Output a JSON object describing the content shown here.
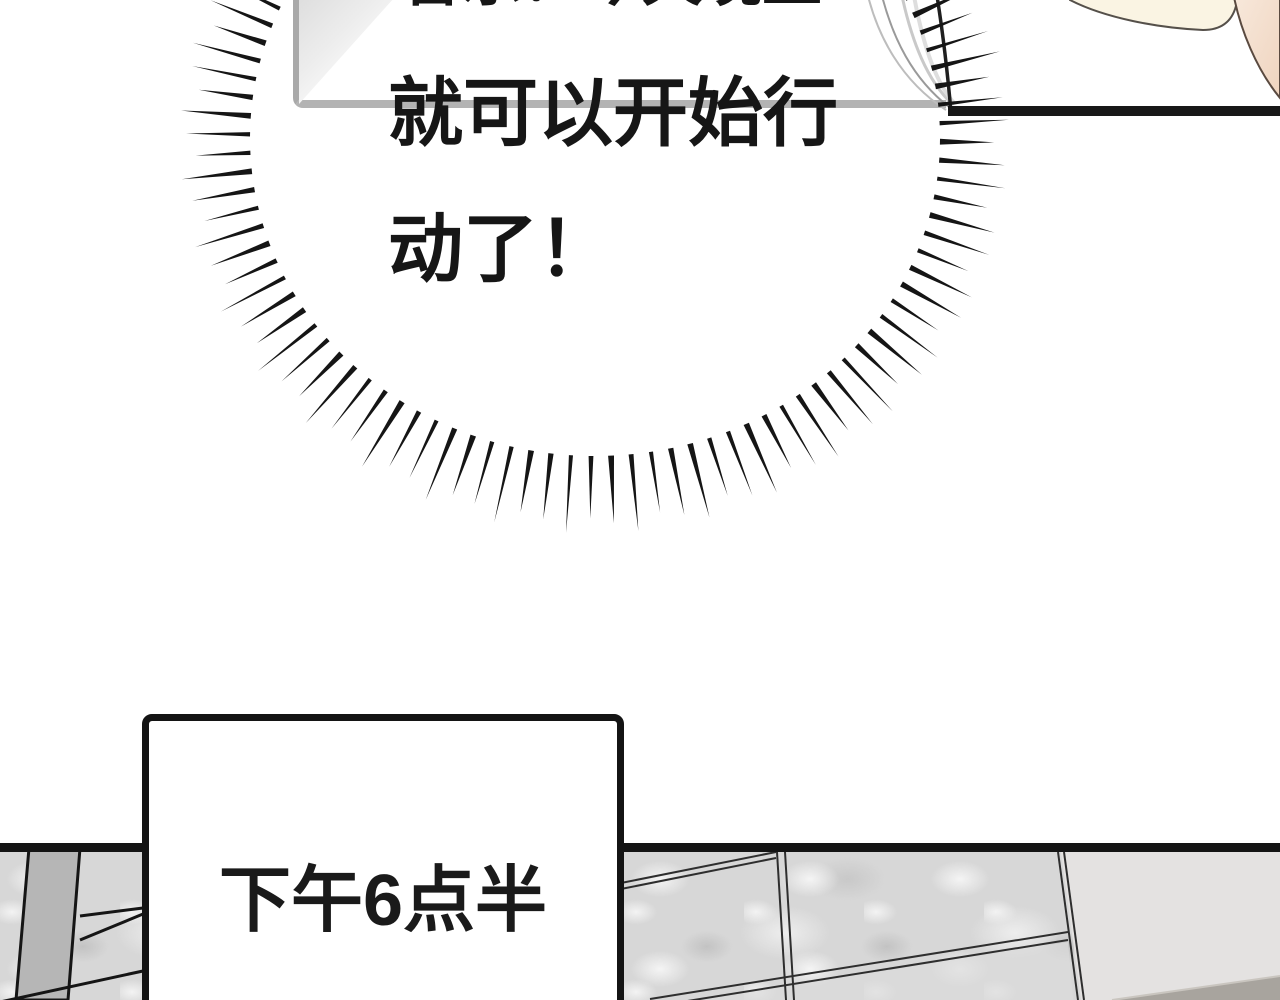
{
  "bubble": {
    "lines": [
      "音乐？今天晚上",
      "就可以开始行",
      "动了！"
    ]
  },
  "caption": {
    "text": "下午6点半"
  },
  "burst": {
    "cx": 595,
    "cy": 138,
    "irx": 345,
    "iry": 318,
    "orx": 408,
    "ory": 387,
    "start_deg": -26,
    "end_deg": 204,
    "count": 70,
    "base_width": 5,
    "color": "#151515"
  },
  "colors": {
    "ink": "#161616",
    "top_box_border": "#b3b3b3",
    "caption_border": "#141414",
    "cream_object": "#faf4e3",
    "skin": "#f6e2d2",
    "panel_texture": "#d7d7d7",
    "panel_smooth": "#e4e2e1",
    "panel_wedge": "#a8a49e"
  }
}
